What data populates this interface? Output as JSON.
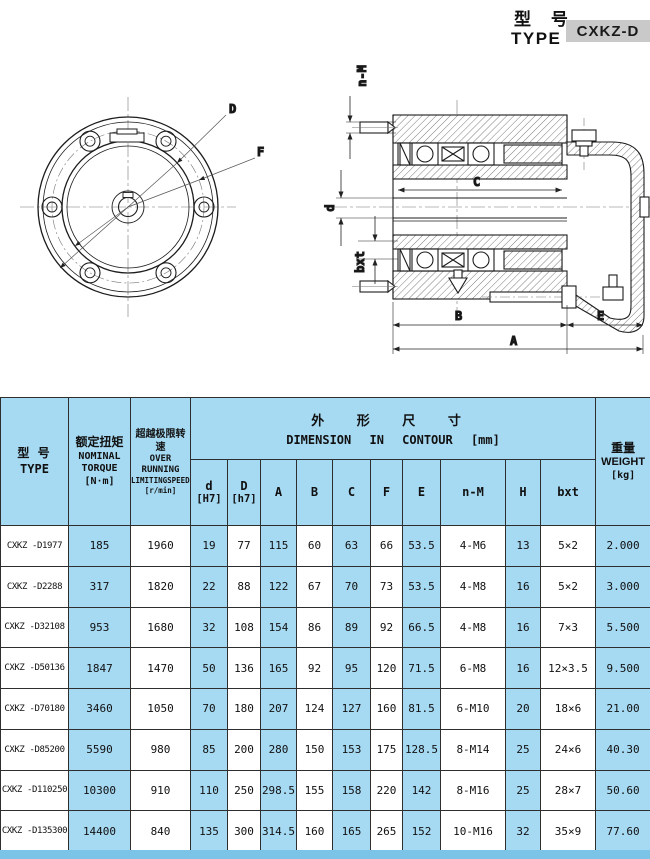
{
  "header": {
    "title_cn": "型 号",
    "title_en": "TYPE",
    "model_box": "CXKZ-D"
  },
  "drawings": {
    "front": {
      "d_label": "D",
      "f_label": "F"
    },
    "section": {
      "nm_label": "n-M",
      "c_label": "C",
      "d_label": "d",
      "bxt_label": "bxt",
      "b_label": "B",
      "e_label": "E",
      "a_label": "A"
    }
  },
  "table": {
    "col_headers": {
      "type": {
        "cn": "型 号",
        "en": "TYPE"
      },
      "torque": {
        "cn": "额定扭矩",
        "en1": "NOMINAL",
        "en2": "TORQUE",
        "unit": "[N·m]"
      },
      "speed": {
        "cn": "超越极限转速",
        "en1": "OVER RUNNING",
        "en2": "LIMITINGSPEEDS",
        "unit": "[r/min]"
      },
      "dimension": {
        "cn": "外 形 尺 寸",
        "en": "DIMENSION IN CONTOUR [mm]"
      },
      "weight": {
        "cn": "重量",
        "en": "WEIGHT",
        "unit": "[kg]"
      },
      "dims": [
        {
          "l1": "d",
          "l2": "[H7]"
        },
        {
          "l1": "D",
          "l2": "[h7]"
        },
        {
          "l1": "A"
        },
        {
          "l1": "B"
        },
        {
          "l1": "C"
        },
        {
          "l1": "F"
        },
        {
          "l1": "E"
        },
        {
          "l1": "n-M"
        },
        {
          "l1": "H"
        },
        {
          "l1": "bxt"
        }
      ]
    },
    "rows": [
      [
        "CXKZ -D1977",
        "185",
        "1960",
        "19",
        "77",
        "115",
        "60",
        "63",
        "66",
        "53.5",
        "4-M6",
        "13",
        "5×2",
        "2.000"
      ],
      [
        "CXKZ -D2288",
        "317",
        "1820",
        "22",
        "88",
        "122",
        "67",
        "70",
        "73",
        "53.5",
        "4-M8",
        "16",
        "5×2",
        "3.000"
      ],
      [
        "CXKZ -D32108",
        "953",
        "1680",
        "32",
        "108",
        "154",
        "86",
        "89",
        "92",
        "66.5",
        "4-M8",
        "16",
        "7×3",
        "5.500"
      ],
      [
        "CXKZ -D50136",
        "1847",
        "1470",
        "50",
        "136",
        "165",
        "92",
        "95",
        "120",
        "71.5",
        "6-M8",
        "16",
        "12×3.5",
        "9.500"
      ],
      [
        "CXKZ -D70180",
        "3460",
        "1050",
        "70",
        "180",
        "207",
        "124",
        "127",
        "160",
        "81.5",
        "6-M10",
        "20",
        "18×6",
        "21.00"
      ],
      [
        "CXKZ -D85200",
        "5590",
        "980",
        "85",
        "200",
        "280",
        "150",
        "153",
        "175",
        "128.5",
        "8-M14",
        "25",
        "24×6",
        "40.30"
      ],
      [
        "CXKZ -D110250",
        "10300",
        "910",
        "110",
        "250",
        "298.5",
        "155",
        "158",
        "220",
        "142",
        "8-M16",
        "25",
        "28×7",
        "50.60"
      ],
      [
        "CXKZ -D135300",
        "14400",
        "840",
        "135",
        "300",
        "314.5",
        "160",
        "165",
        "265",
        "152",
        "10-M16",
        "32",
        "35×9",
        "77.60"
      ]
    ]
  },
  "colors": {
    "cell_blue": "#a6d9f2",
    "bottom_bar": "#7cc3e8",
    "model_box_gray": "#c9c9c9"
  }
}
